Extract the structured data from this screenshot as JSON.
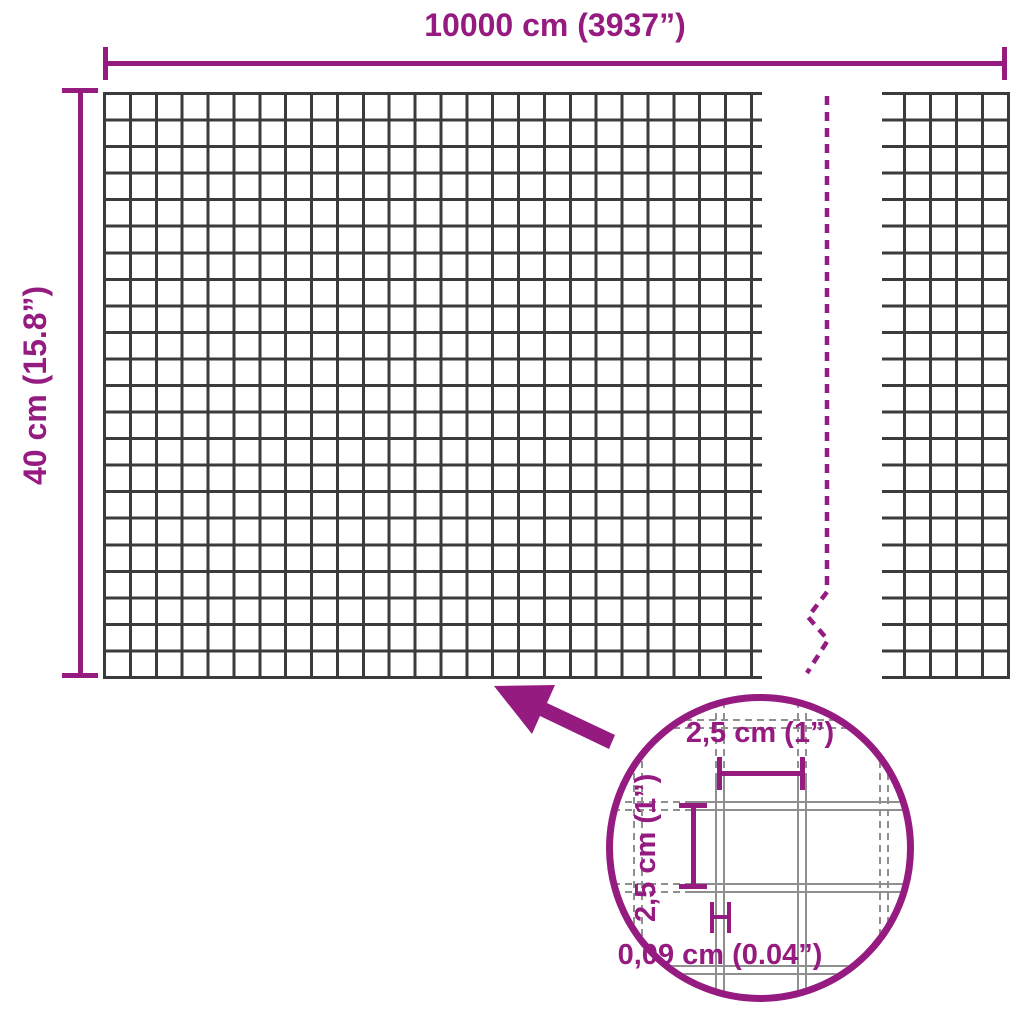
{
  "diagram": {
    "kind": "product-dimension-diagram",
    "subject": "welded wire mesh roll"
  },
  "labels": {
    "total_width": "10000 cm (3937”)",
    "total_height": "40 cm (15.8”)",
    "detail_cell_width": "2,5 cm (1”)",
    "detail_cell_height": "2,5 cm (1”)",
    "detail_wire_thickness": "0,09 cm (0.04”)"
  },
  "colors": {
    "accent": "#951b81",
    "mesh_line": "#3b3b3b",
    "detail_wire": "#8f8f8f",
    "background": "#ffffff"
  }
}
